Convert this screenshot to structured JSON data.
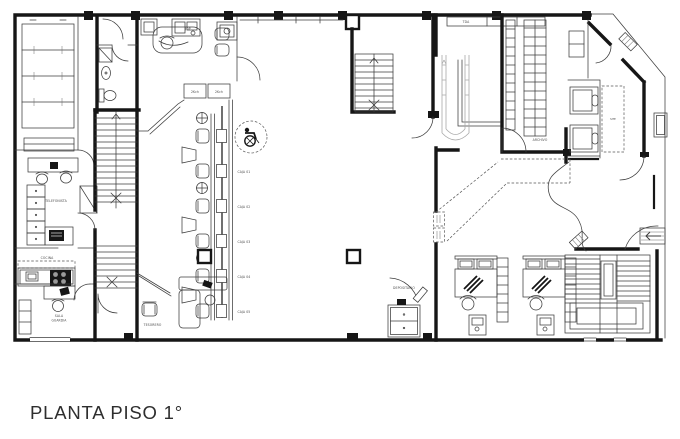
{
  "labels": {
    "title": "PLANTA PISO 1°",
    "jop": "JOP",
    "tda": "TDA",
    "archivo": "ARCHIVO",
    "site": "SITE",
    "telefonista": "TELEFONISTA",
    "cocina": "COCINA",
    "sala_line1": "SALA",
    "sala_line2": "GUARDIA",
    "tesorero": "TESORERO",
    "depositario": "DEPOSITARIO",
    "kch_left": "2Kch",
    "kch_right": "2Kch",
    "cajas": [
      "CAJA 01",
      "CAJA 02",
      "CAJA 03",
      "CAJA 04",
      "CAJA 05"
    ]
  },
  "colors": {
    "wall_ink": "#161616",
    "thin_ink": "#3d3d3d",
    "gray_stair": "#a9a9a9",
    "label_ink": "#4a4a4a",
    "background": "#ffffff"
  }
}
